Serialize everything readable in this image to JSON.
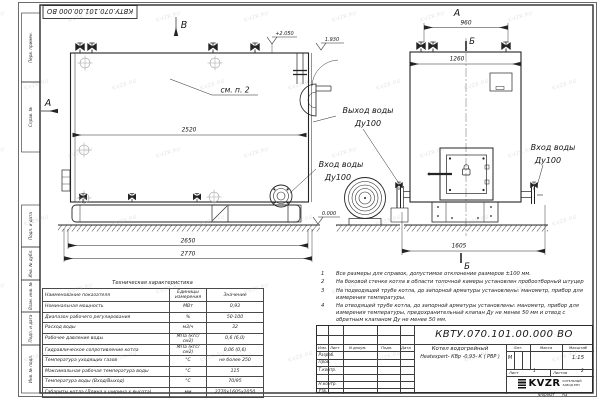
{
  "watermark": {
    "text": "KVZR.RU"
  },
  "frame": {
    "corner_stamp": "КВТУ.070.101.00.000  ВО",
    "margin_labels": [
      "Перв. примен.",
      "Справ. №",
      "Подп. и дата",
      "Инв. № дубл.",
      "Взам. инв. №",
      "Подп. и дата",
      "Инв. № подл."
    ],
    "format_label": "Формат",
    "format_value": "А3"
  },
  "drawing": {
    "views": {
      "front_top_label": "В",
      "front_left_label": "А",
      "side_top_label": "А",
      "section_top_label": "Б",
      "section_bottom_label": "Б"
    },
    "callout_note": "см. п. 2",
    "elevations": {
      "top": "+2.050",
      "outlet": "1.930",
      "ground": "0.000"
    },
    "dimensions": {
      "front_inner": "2520",
      "front_base": "2650",
      "front_overall": "2770",
      "side_nozzles": "960",
      "side_width": "1260",
      "side_depth": "1605"
    },
    "labels": {
      "water_outlet": {
        "line1": "Выход воды",
        "line2": "Ду100"
      },
      "water_inlet_front": {
        "line1": "Вход воды",
        "line2": "Ду100"
      },
      "water_inlet_side": {
        "line1": "Вход воды",
        "line2": "Ду100"
      }
    }
  },
  "notes": [
    {
      "num": "1",
      "text": "Все размеры для справок, допустимое отклонение размеров ±100 мм."
    },
    {
      "num": "2",
      "text": "На боковой стенке котла в области топочной камеры установлен пробоотборный штуцер"
    },
    {
      "num": "3",
      "text": "На  подводящей трубе котла, до запорной арматуры установлены:  манометр, прибор для измерения температуры."
    },
    {
      "num": "4",
      "text": "На отводящей трубе котла, до запорной арматуры установлены: манометр, прибор для измерения температуры, предохранительный клапан  Ду не менее 50 мм и отвод с обратным клапаном  Ду не менее 50 мм."
    }
  ],
  "spec_table": {
    "title": "Техническая характеристика",
    "headers": [
      "Наименование показателя",
      "Единицы измерения",
      "Значение"
    ],
    "rows": [
      [
        "Номинальная мощность",
        "МВт",
        "0,93"
      ],
      [
        "Диапазон рабочего регулирования",
        "%",
        "50-100"
      ],
      [
        "Расход воды",
        "м3/ч",
        "32"
      ],
      [
        "Рабочее давление воды",
        "МПа (кгс/см2)",
        "0,6 (6,0)"
      ],
      [
        "Гидравлическое сопротивление котла",
        "МПа (кгс/см2)",
        "0,06 (0,6)"
      ],
      [
        "Температура уходящих газов",
        "°С",
        "не более 250"
      ],
      [
        "Максимальная рабочая температура воды",
        "°С",
        "115"
      ],
      [
        "Температура воды (Вход/Выход)",
        "°С",
        "70/95"
      ],
      [
        "Габариты котла (Длина х ширина х высота)",
        "мм",
        "2770х1605х2050"
      ]
    ]
  },
  "title_block": {
    "doc_number": "КВТУ.070.101.00.000  ВО",
    "product_line1": "Котел водогрейный",
    "product_line2": "Heatexpert- КВр -0,93- К ( РВР )",
    "header_cols": [
      "Изм.",
      "Лист",
      "N докум.",
      "Подп.",
      "Дата"
    ],
    "row_labels": [
      "Разраб.",
      "Пров.",
      "Т.контр.",
      "Н.контр.",
      "Утв."
    ],
    "lit_label": "Лит.",
    "lit_value": "М",
    "mass_label": "Масса",
    "scale_label": "Масштаб",
    "scale_value": "1:15",
    "sheet_label": "Лист",
    "sheet_value": "1",
    "sheets_label": "Листов",
    "sheets_value": "2",
    "logo_text": "KVZR",
    "company_line1": "КОТЕЛЬНЫЙ",
    "company_line2": "ЗАВОД РЭП"
  }
}
